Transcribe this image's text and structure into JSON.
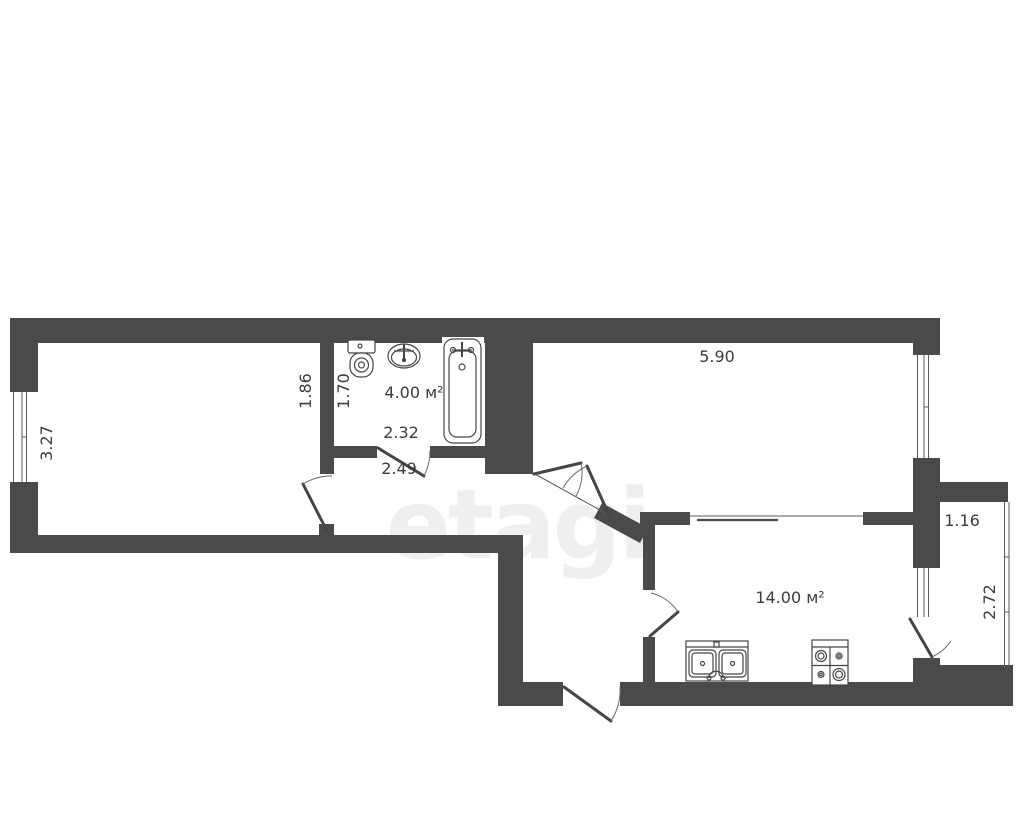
{
  "watermark": "etagi",
  "colors": {
    "wall": "#4a4a4a",
    "line": "#454545",
    "text": "#3c3c3c",
    "watermark": "#f1eeee",
    "background": "#ffffff"
  },
  "floor_plan": {
    "dimensions": {
      "left_room_height": "3.27",
      "left_of_bathroom": "1.86",
      "bathroom_width": "1.70",
      "bathroom_area": "4.00 м²",
      "bathroom_length": "2.32",
      "hallway_length": "2.49",
      "right_room_width": "5.90",
      "kitchen_area": "14.00 м²",
      "balcony_width": "1.16",
      "balcony_height": "2.72"
    },
    "fixtures": [
      "toilet",
      "washbasin",
      "bathtub",
      "kitchen-sink",
      "stove"
    ]
  }
}
